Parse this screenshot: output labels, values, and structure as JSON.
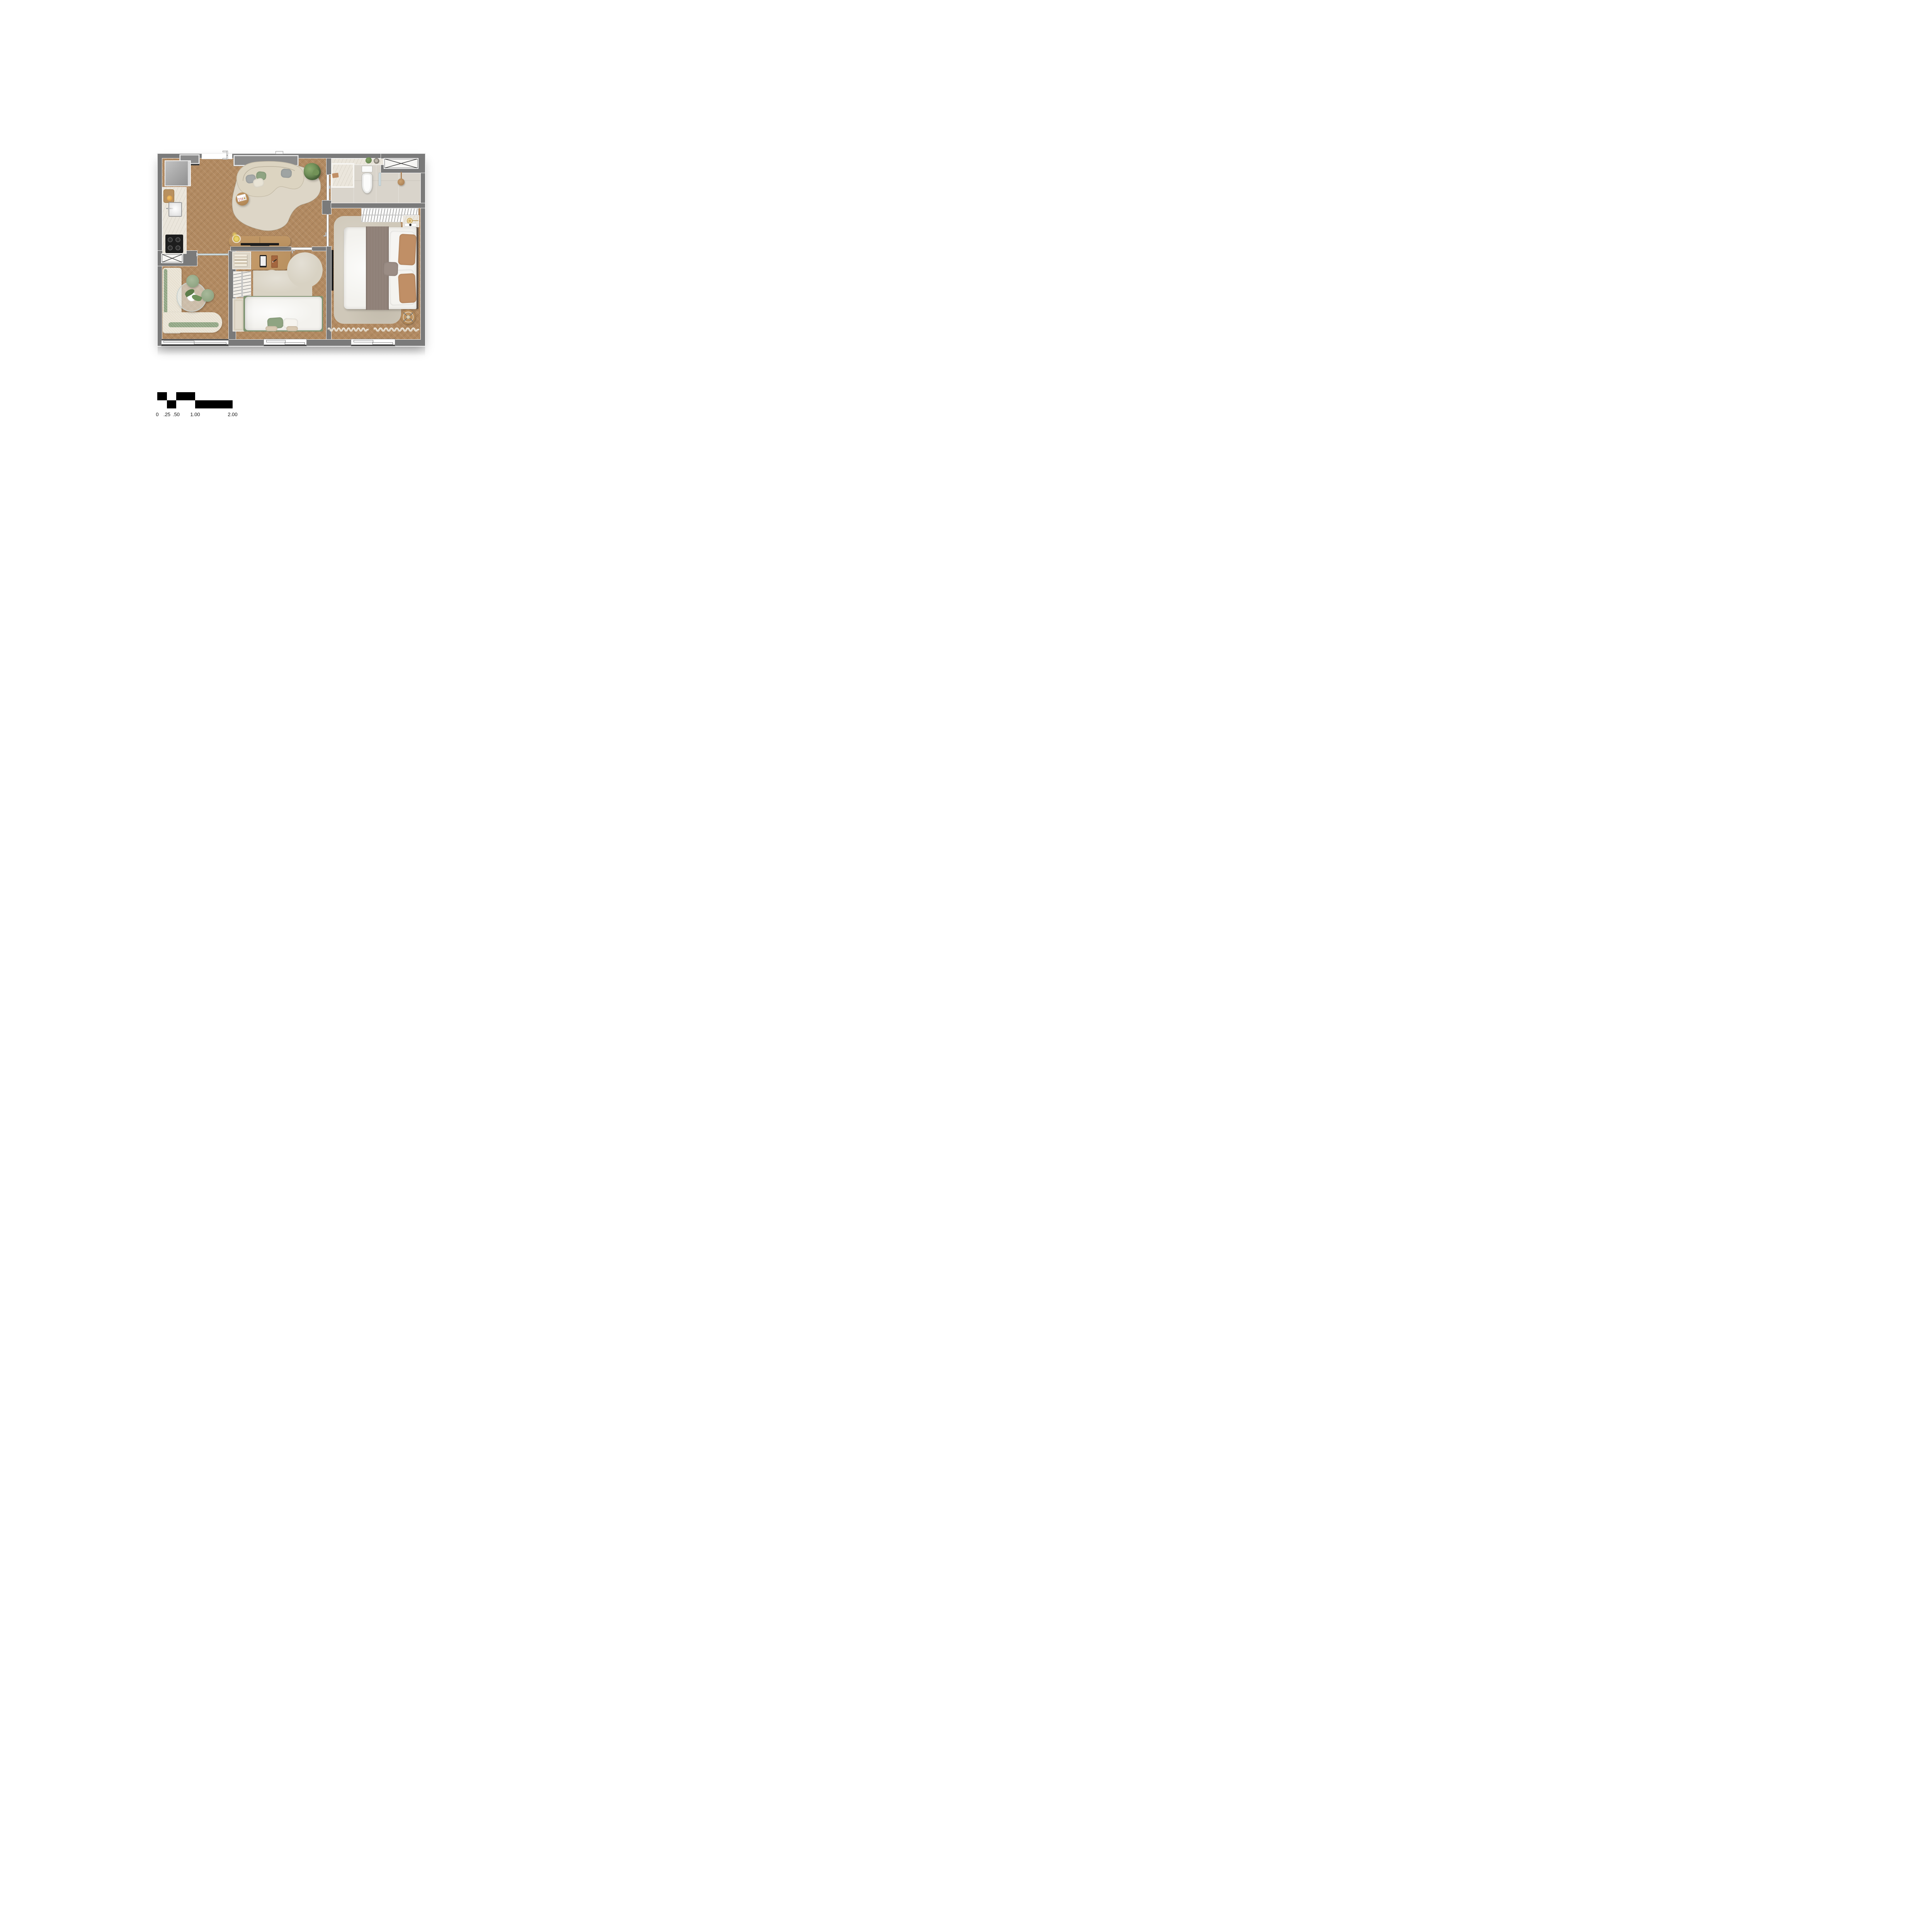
{
  "scale_bar": {
    "labels": [
      "0",
      ".25",
      ".50",
      "1.00",
      "2.00"
    ]
  },
  "living_room": {
    "magazine_title": "THE BOO"
  },
  "theme": {
    "wall": "#7a7a7a",
    "wall_trim": "#f4f4f4",
    "floor_wood": "#b28a61",
    "floor_stone": "#d9d4cb",
    "marble": "#ebe6dc",
    "rug": "#ddd6c7",
    "rug_dark": "#cfc8b9",
    "rug_small": "#d8d2c3",
    "cream": "#e7e0d0",
    "sofa": "#dcd4c1",
    "green": "#8fa482",
    "green_dark": "#7f9472",
    "wood": "#b8905f",
    "wood_dark": "#a77e4e",
    "bed_white": "#f3f2ee",
    "throw": "#8d7e75",
    "tan": "#c08f66",
    "black": "#1d1d1d",
    "bronze": "#ad8459",
    "glass": "#cfdce0",
    "sill_dark": "#3f3f3f"
  }
}
